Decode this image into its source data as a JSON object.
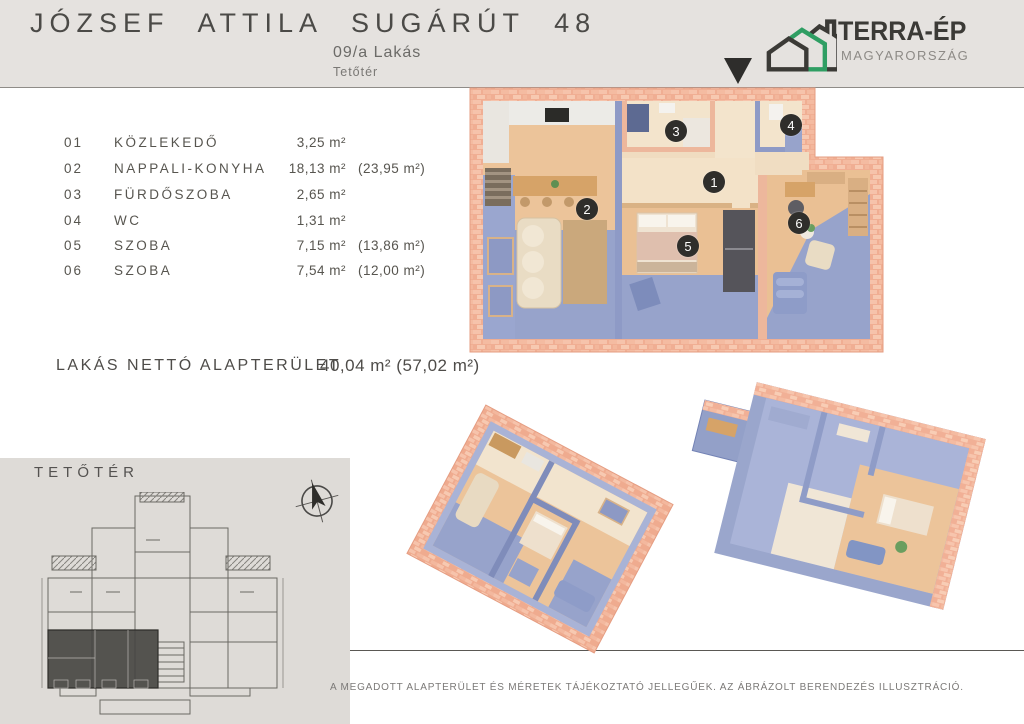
{
  "header": {
    "title": "JÓZSEF ATTILA SUGÁRÚT 48",
    "subtitle": "09/a Lakás",
    "floor": "Tetőtér",
    "logo": {
      "name": "TERRA-ÉP",
      "country": "MAGYARORSZÁG",
      "accent_green": "#2f9e63",
      "dark": "#3b3a36"
    }
  },
  "rooms": [
    {
      "num": "01",
      "name": "KÖZLEKEDŐ",
      "area": "3,25 m²",
      "gross": ""
    },
    {
      "num": "02",
      "name": "NAPPALI-KONYHA",
      "area": "18,13 m²",
      "gross": "(23,95 m²)"
    },
    {
      "num": "03",
      "name": "FÜRDŐSZOBA",
      "area": "2,65 m²",
      "gross": ""
    },
    {
      "num": "04",
      "name": "WC",
      "area": "1,31 m²",
      "gross": ""
    },
    {
      "num": "05",
      "name": "SZOBA",
      "area": "7,15 m²",
      "gross": "(13,86 m²)"
    },
    {
      "num": "06",
      "name": "SZOBA",
      "area": "7,54 m²",
      "gross": "(12,00 m²)"
    }
  ],
  "total": {
    "label": "LAKÁS NETTÓ ALAPTERÜLET",
    "value": "40,04 m² (57,02 m²)"
  },
  "panel": {
    "floor_label": "TETŐTÉR"
  },
  "plan": {
    "badges": [
      "1",
      "2",
      "3",
      "4",
      "5",
      "6"
    ],
    "colors": {
      "brick": "#f2b39a",
      "brick_light": "#f8d2bd",
      "wall_blue": "#8e9ac6",
      "floor_wood": "#ecc49a",
      "floor_pale": "#f3e4cc",
      "roof_blue": "#97a3cb",
      "badge_bg": "#2f2e2b"
    }
  },
  "footer": {
    "disclaimer": "A MEGADOTT ALAPTERÜLET ÉS MÉRETEK TÁJÉKOZTATÓ JELLEGŰEK. AZ ÁBRÁZOLT BERENDEZÉS ILLUSZTRÁCIÓ."
  }
}
